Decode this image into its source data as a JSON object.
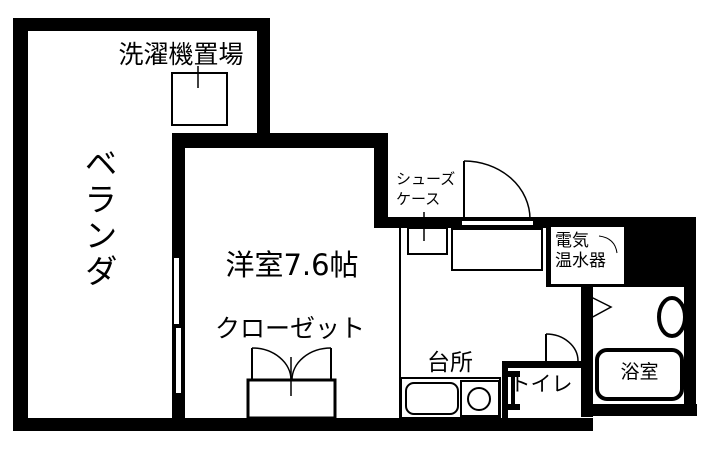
{
  "floorplan": {
    "type": "apartment-floor-plan",
    "colors": {
      "wall": "#000000",
      "background": "#ffffff"
    },
    "labels": {
      "veranda": "ベランダ",
      "laundry": "洗濯機置場",
      "western_room": "洋室7.6帖",
      "closet": "クローゼット",
      "shoe_case_line1": "シューズ",
      "shoe_case_line2": "ケース",
      "water_heater_line1": "電気",
      "water_heater_line2": "温水器",
      "kitchen": "台所",
      "toilet": "トイレ",
      "bathroom": "浴室"
    }
  }
}
